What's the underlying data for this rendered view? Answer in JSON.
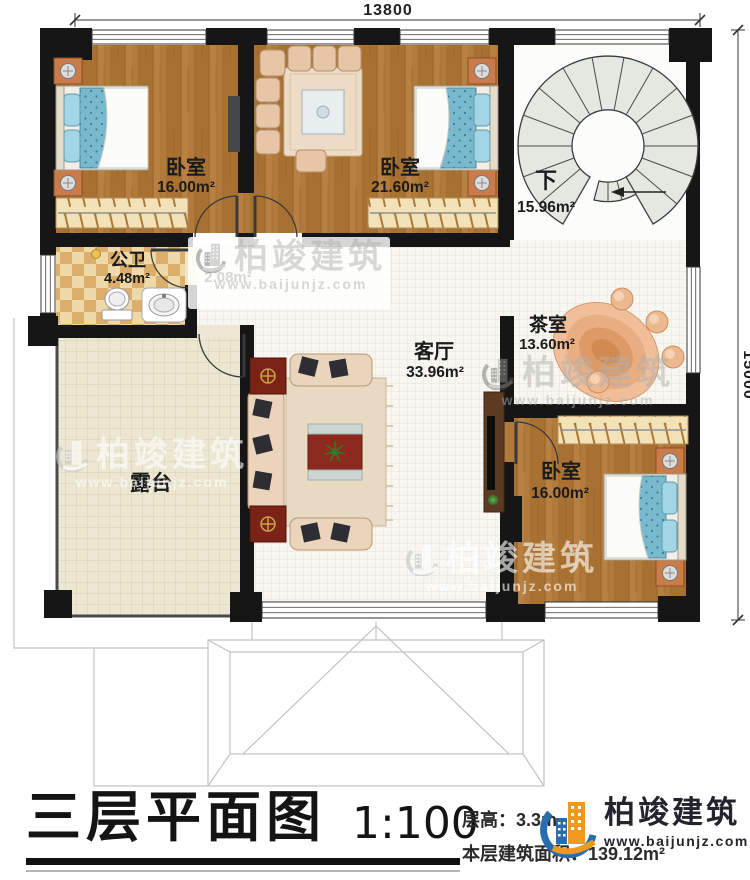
{
  "dimensions": {
    "top": "13800",
    "right": "15000"
  },
  "rooms": {
    "bedroom1": {
      "label": "卧室",
      "area": "16.00m²"
    },
    "bedroom2": {
      "label": "卧室",
      "area": "21.60m²"
    },
    "stairwell": {
      "label": "下",
      "area": "15.96m²"
    },
    "bathroom": {
      "label": "公卫",
      "area": "4.48m²"
    },
    "hallway": {
      "area": "2.08m²"
    },
    "living": {
      "label": "客厅",
      "area": "33.96m²"
    },
    "tearoom": {
      "label": "茶室",
      "area": "13.60m²"
    },
    "bedroom3": {
      "label": "卧室",
      "area": "16.00m²"
    },
    "terrace": {
      "label": "露台"
    }
  },
  "title_block": {
    "title": "三层平面图",
    "scale": "1:100",
    "floor_height": "层高：3.3m",
    "floor_area": "本层建筑面积：139.12m²"
  },
  "branding": {
    "company": "柏竣建筑",
    "website": "www.baijunjz.com"
  },
  "colors": {
    "wall": "#161616",
    "wood_floor": "#b1793a",
    "terrace_tile": "#ebe7d2",
    "bathroom_tile": "#e0b26e",
    "bed_blue": "#79b9cd",
    "stair_tread": "#e3e9e1",
    "brand_orange": "#f2981d",
    "brand_blue": "#2a6cb0"
  }
}
